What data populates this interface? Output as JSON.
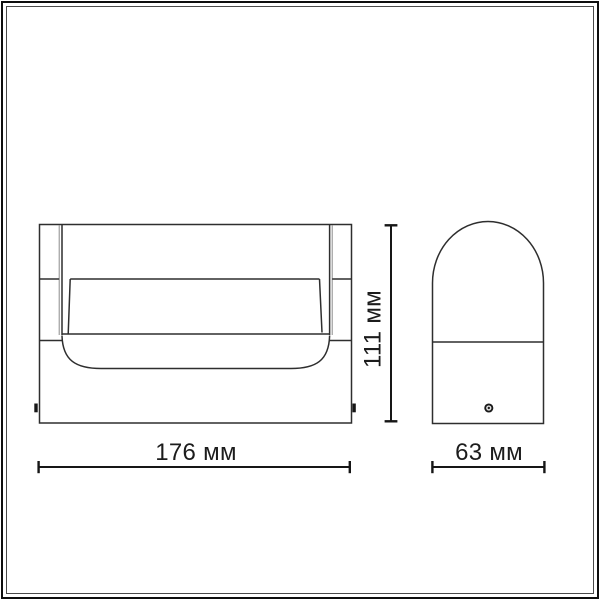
{
  "page": {
    "background": "#ffffff",
    "frame": {
      "outer_border_color": "#0e0e0e",
      "inner_border_color": "#4a4a4a"
    }
  },
  "drawing": {
    "line_color": "#2e2e2e",
    "dimension_line_color": "#161616",
    "text_color": "#1c1c1c",
    "dimensions": {
      "width": {
        "label": "176 мм",
        "value": 176,
        "unit": "мм"
      },
      "height": {
        "label": "111 мм",
        "value": 111,
        "unit": "мм"
      },
      "depth": {
        "label": "63 мм",
        "value": 63,
        "unit": "мм"
      }
    }
  }
}
